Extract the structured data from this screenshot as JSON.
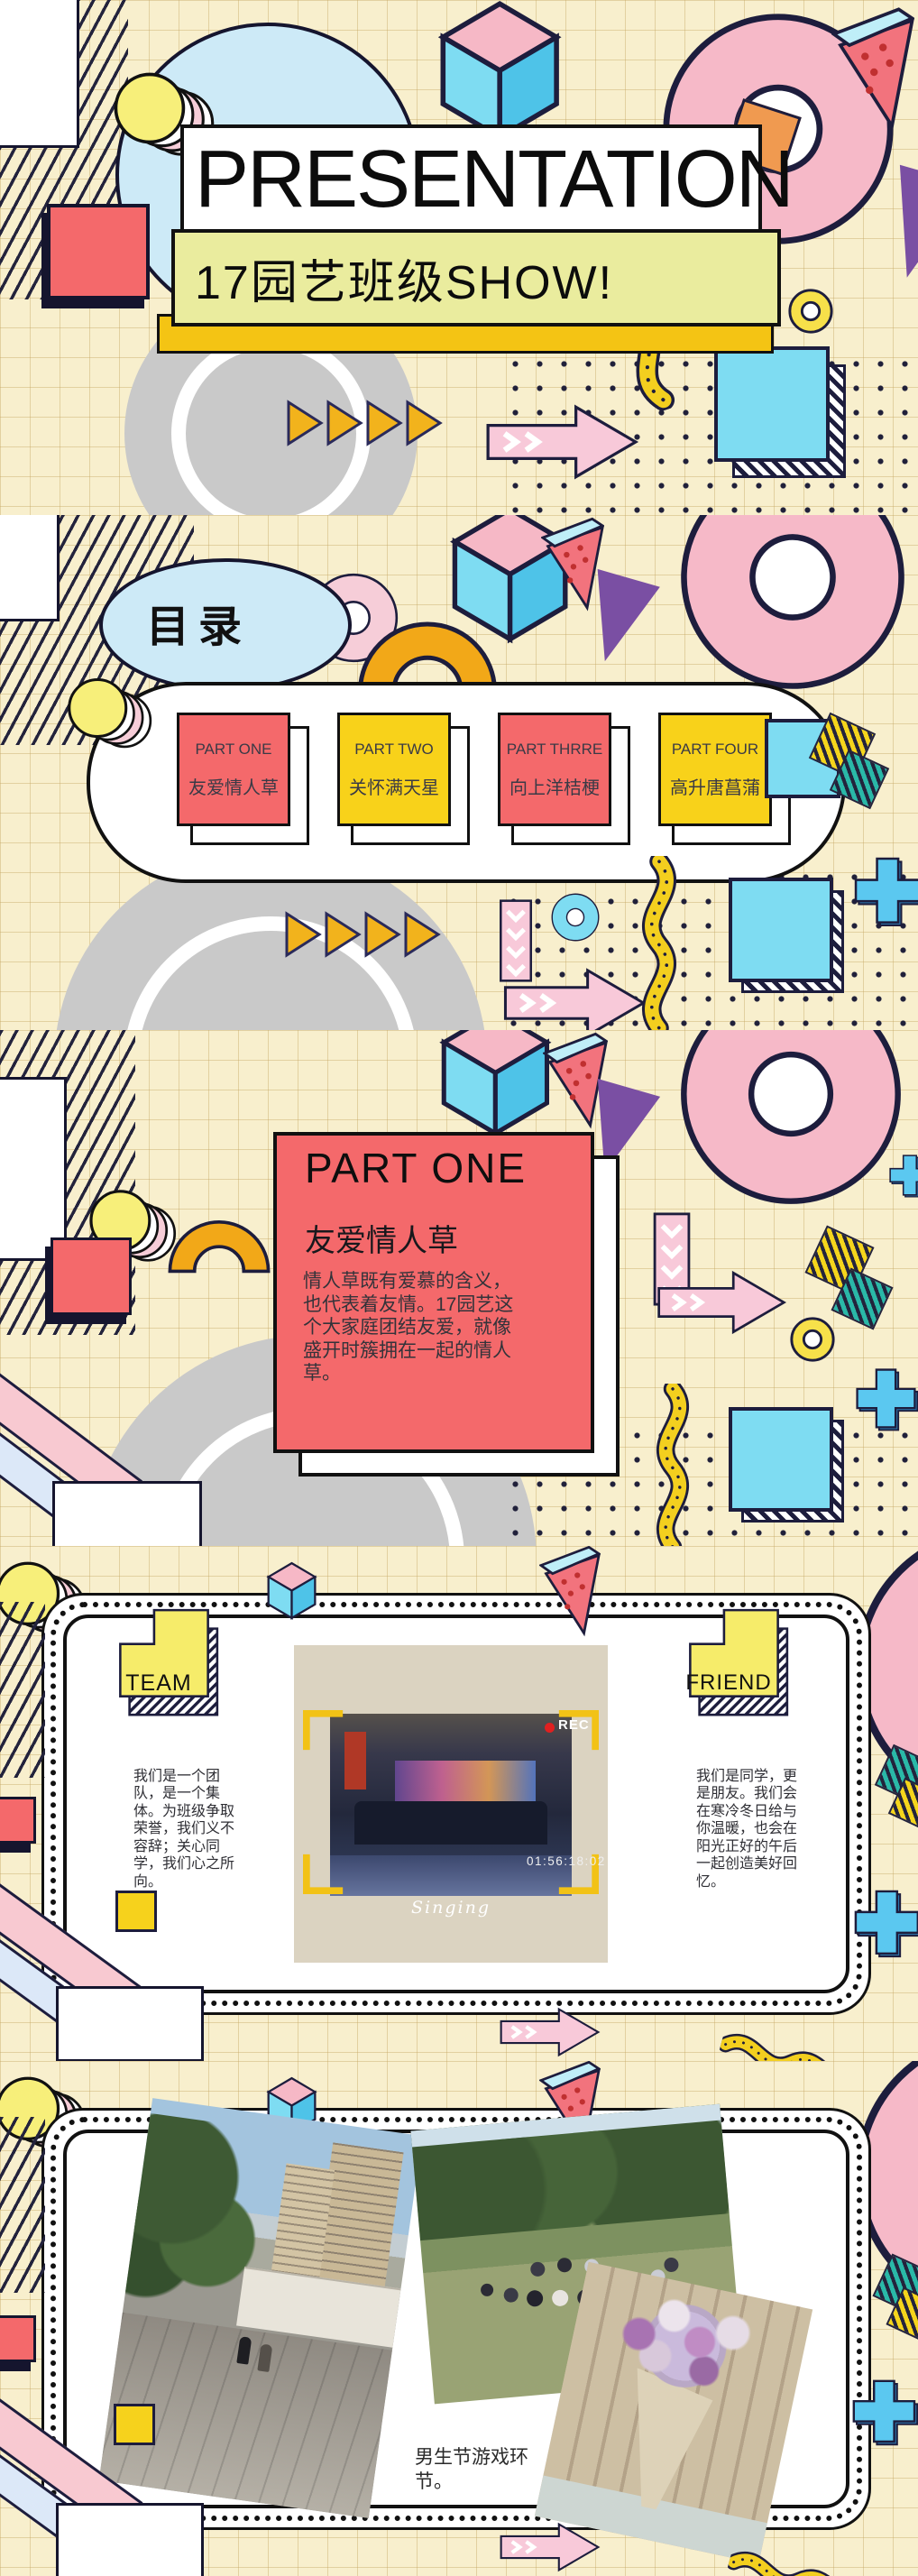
{
  "slide1": {
    "title": "PRESENTATION",
    "subtitle": "17园艺班级SHOW!"
  },
  "slide2": {
    "heading": "目录",
    "items": [
      {
        "part": "PART ONE",
        "title": "友爱情人草"
      },
      {
        "part": "PART TWO",
        "title": "关怀满天星"
      },
      {
        "part": "PART THRRE",
        "title": "向上洋桔梗"
      },
      {
        "part": "PART FOUR",
        "title": "高升唐菖蒲"
      }
    ]
  },
  "slide3": {
    "part": "PART ONE",
    "title": "友爱情人草",
    "body": "情人草既有爱慕的含义，也代表着友情。17园艺这个大家庭团结友爱，就像盛开时簇拥在一起的情人草。"
  },
  "slide4": {
    "left_badge": "TEAM",
    "right_badge": "FRIEND",
    "left_text": "我们是一个团队，是一个集体。为班级争取荣誉，我们义不容辞；关心同学，我们心之所向。",
    "right_text": "我们是同学，更是朋友。我们会在寒冷冬日给与你温暖，也会在阳光正好的午后一起创造美好回忆。",
    "overlay": {
      "rec": "REC",
      "timecode": "01:56:18:02",
      "caption": "Singing"
    }
  },
  "slide5": {
    "caption": "男生节游戏环节。"
  },
  "colors": {
    "coral": "#f4696b",
    "card_yellow": "#f8d21a",
    "gold": "#f0a818",
    "cream_bg": "#f7eecb",
    "light_blue": "#cdeaf7",
    "cyan": "#6fd6ee",
    "pink": "#f7c3d4",
    "subtitle_yellow": "#eaec9e",
    "navy_outline": "#1d1d3d",
    "purple": "#7a4fa3"
  }
}
